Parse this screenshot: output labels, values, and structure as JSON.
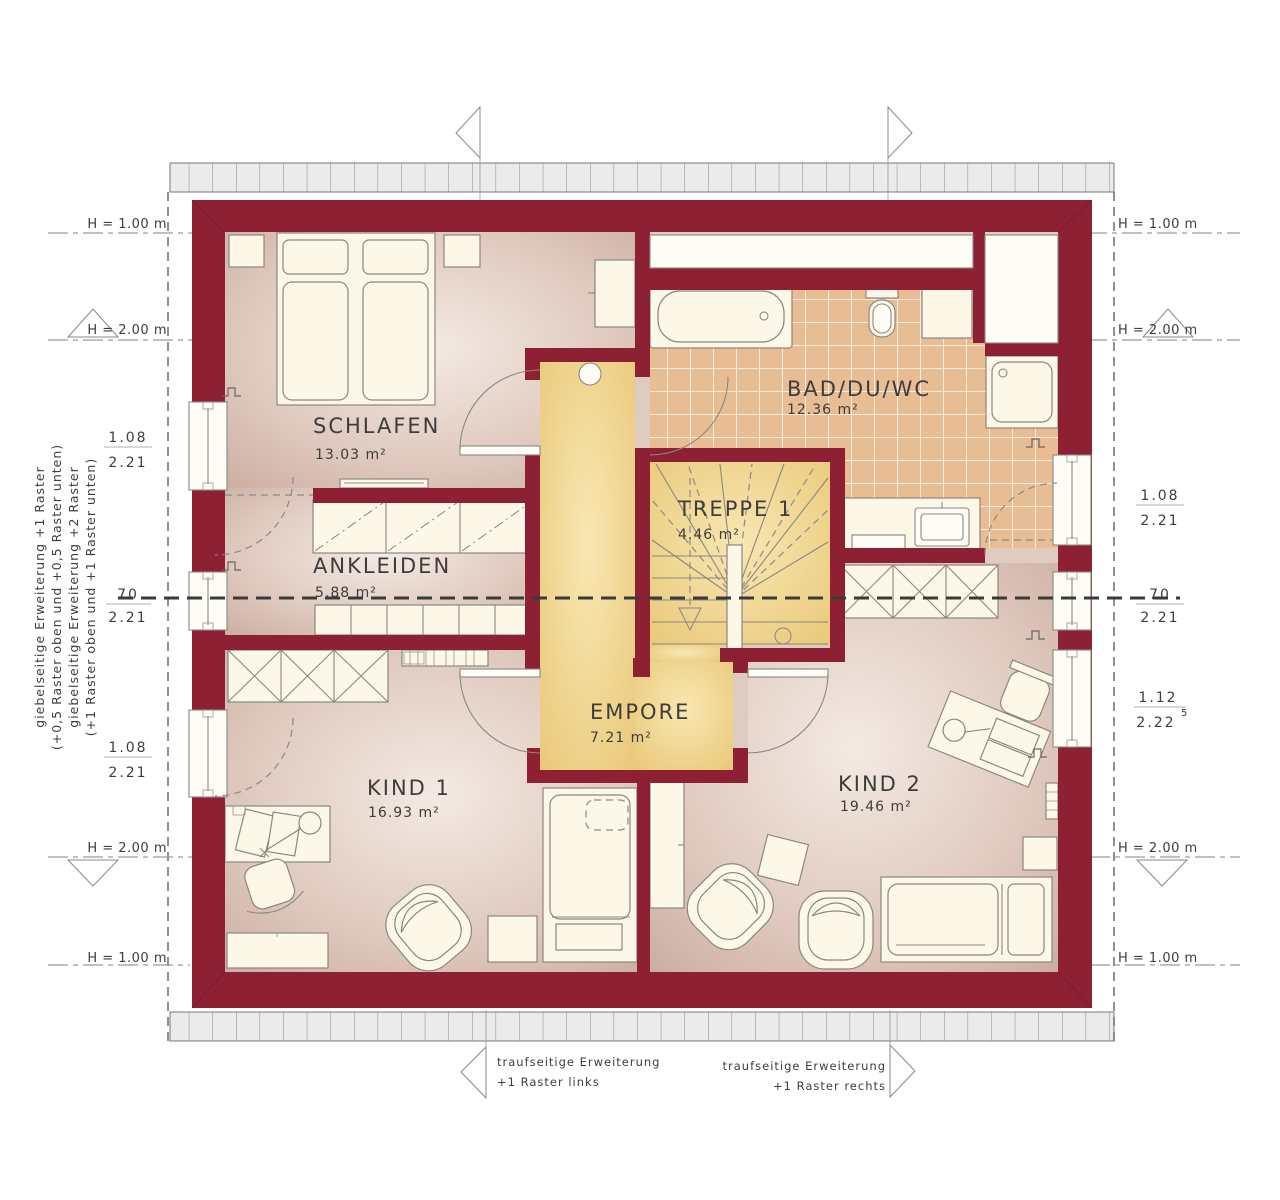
{
  "plan": {
    "rooms": {
      "schlafen": {
        "name": "SCHLAFEN",
        "area": "13.03 m²"
      },
      "ankleiden": {
        "name": "ANKLEIDEN",
        "area": "5.88 m²"
      },
      "bad": {
        "name": "BAD/DU/WC",
        "area": "12.36 m²"
      },
      "treppe": {
        "name": "TREPPE 1",
        "area": "4.46 m²"
      },
      "empore": {
        "name": "EMPORE",
        "area": "7.21 m²"
      },
      "kind1": {
        "name": "KIND 1",
        "area": "16.93 m²"
      },
      "kind2": {
        "name": "KIND 2",
        "area": "19.46 m²"
      }
    },
    "height_markers": {
      "h100": "H = 1.00 m",
      "h200": "H = 2.00 m"
    },
    "dimensions": {
      "left_top": {
        "num": "1.08",
        "den": "2.21"
      },
      "left_mid": {
        "num": "70",
        "den": "2.21"
      },
      "left_bottom": {
        "num": "1.08",
        "den": "2.21"
      },
      "right_top": {
        "num": "1.08",
        "den": "2.21"
      },
      "right_mid": {
        "num": "70",
        "den": "2.21"
      },
      "right_bottom": {
        "num": "1.12",
        "den": "2.22",
        "sup": "5"
      }
    },
    "side_note": {
      "line1": "giebelseitige Erweiterung +1 Raster",
      "line2": "(+0,5 Raster oben und +0,5 Raster unten)",
      "line3": "giebelseitige Erweiterung +2 Raster",
      "line4": "(+1 Raster oben und +1 Raster unten)"
    },
    "bottom_notes": {
      "left_line1": "traufseitige Erweiterung",
      "left_line2": "+1 Raster links",
      "right_line1": "traufseitige Erweiterung",
      "right_line2": "+1 Raster rechts"
    },
    "colors": {
      "wall": "#8e2034",
      "floor_light": "#f3e9e2",
      "floor_dark": "#c9aca0",
      "gallery_light": "#f7e5ae",
      "gallery_dark": "#e9c878",
      "tile": "#e9bd93",
      "tile_line": "#f7ecdc",
      "furniture": "#fcf7e6",
      "outline": "#8b8781",
      "text": "#3d3d3d",
      "strip": "#ebebeb"
    }
  }
}
